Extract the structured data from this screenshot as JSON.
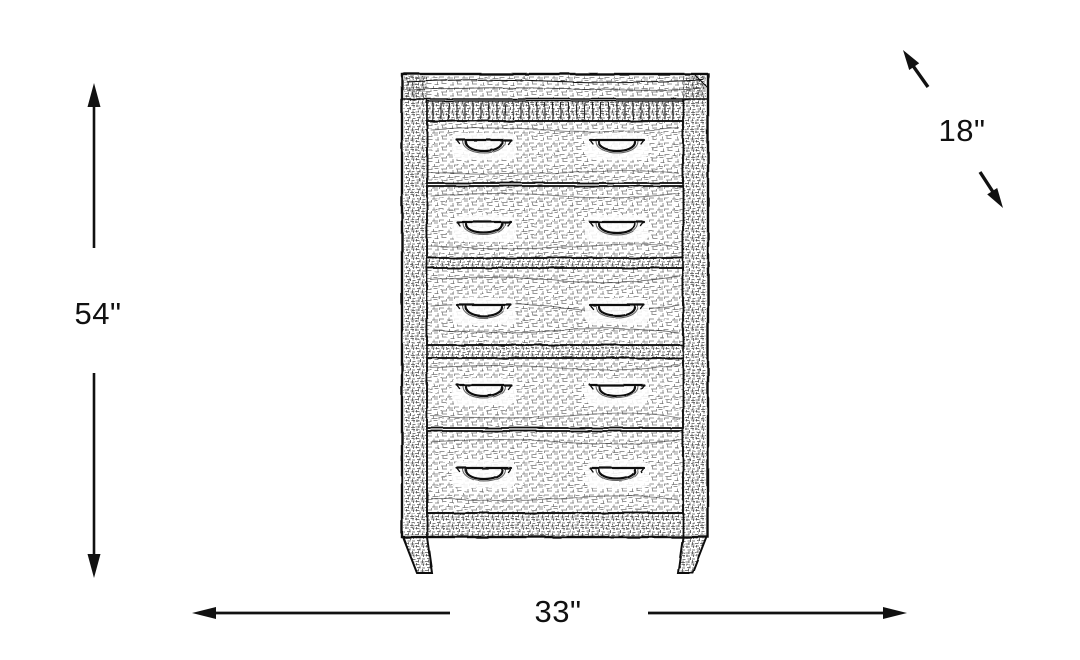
{
  "canvas": {
    "width": 1080,
    "height": 660,
    "background": "#ffffff",
    "ink": "#111111"
  },
  "diagram": {
    "kind": "furniture-dimension-diagram",
    "labels": {
      "height": "54\"",
      "width": "33\"",
      "depth": "18\""
    },
    "arrows": [
      {
        "name": "height-arrow",
        "orientation": "vertical"
      },
      {
        "name": "width-arrow",
        "orientation": "horizontal"
      },
      {
        "name": "depth-arrow",
        "orientation": "diagonal"
      }
    ]
  }
}
